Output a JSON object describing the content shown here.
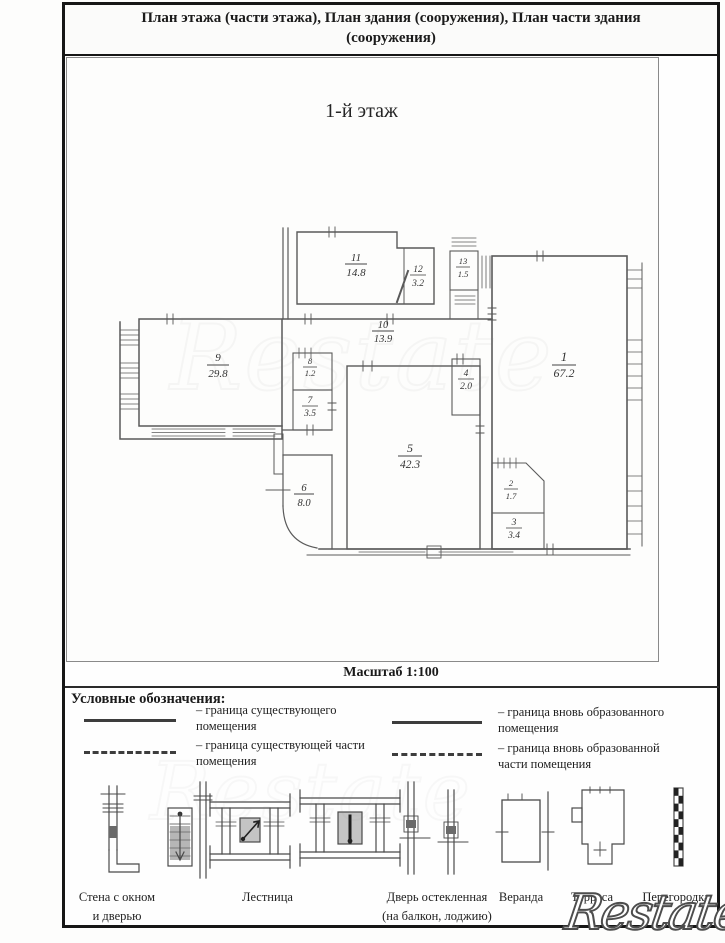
{
  "document": {
    "title": "План этажа (части этажа), План здания (сооружения), План части здания (сооружения)",
    "floor_label": "1-й этаж",
    "scale_label": "Масштаб 1:100",
    "watermark": "Restate"
  },
  "plan": {
    "rooms": [
      {
        "number": "1",
        "area": "67.2"
      },
      {
        "number": "2",
        "area": "1.7"
      },
      {
        "number": "3",
        "area": "3.4"
      },
      {
        "number": "4",
        "area": "2.0"
      },
      {
        "number": "5",
        "area": "42.3"
      },
      {
        "number": "6",
        "area": "8.0"
      },
      {
        "number": "7",
        "area": "3.5"
      },
      {
        "number": "8",
        "area": "1.2"
      },
      {
        "number": "9",
        "area": "29.8"
      },
      {
        "number": "10",
        "area": "13.9"
      },
      {
        "number": "11",
        "area": "14.8"
      },
      {
        "number": "12",
        "area": "3.2"
      },
      {
        "number": "13",
        "area": "1.5"
      }
    ]
  },
  "legend": {
    "heading": "Условные обозначения:",
    "items": [
      {
        "style": "solid",
        "label": "– граница существующего помещения"
      },
      {
        "style": "dashed",
        "label": "– граница существующей части помещения"
      },
      {
        "style": "solid",
        "label": "– граница вновь образованного помещения"
      },
      {
        "style": "dashed",
        "label": "– граница вновь образованной части помещения"
      }
    ],
    "symbols": [
      {
        "label": "Стена с окном и дверью"
      },
      {
        "label": "Лестница"
      },
      {
        "label": "Дверь остекленная (на балкон, лоджию)"
      },
      {
        "label": "Веранда"
      },
      {
        "label": "Терраса"
      },
      {
        "label": "Перегородка"
      }
    ]
  }
}
